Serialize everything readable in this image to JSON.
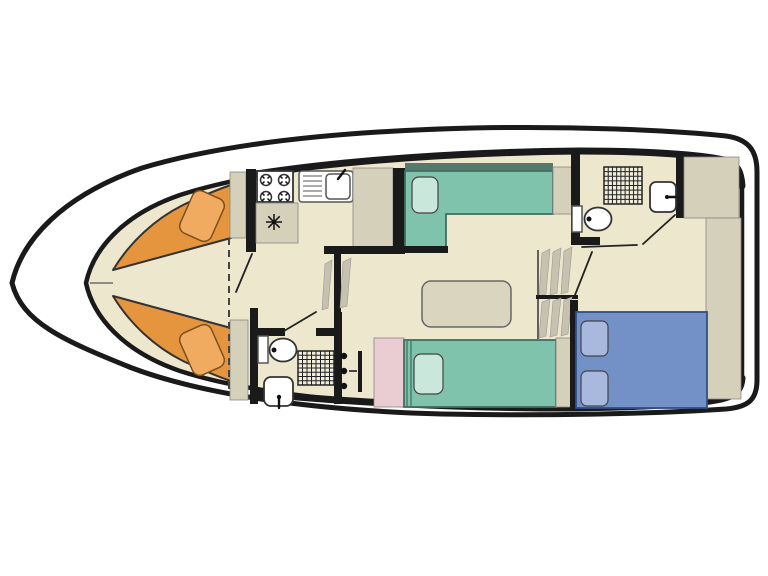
{
  "floorplan": {
    "type": "boat-floor-plan-top-view",
    "background": "#ffffff",
    "colors": {
      "outline": "#1a1a1a",
      "hull_white": "#ffffff",
      "floor": "#ECE7CD",
      "counter": "#D4D0B9",
      "berth_orange": "#E6953F",
      "pillow_orange": "#F0AB61",
      "bed_teal": "#7FC3AD",
      "pillow_teal": "#C9E7DA",
      "bed_teal_headrail": "#56796E",
      "bed_blue": "#7390C7",
      "pillow_blue": "#A9B9DE",
      "wardrobe_pink": "#EACCD3",
      "steps": "#C6C2AF",
      "table": "#D9D5BE",
      "appliance_panel": "#F2F0E6",
      "fixture_white": "#FFFFFF",
      "shower_floor": "#F0EDDA"
    },
    "rooms": {
      "bow_cabin": "v-berth-double",
      "galley": "kitchen-with-hob-sink-fridge",
      "saloon": "table-and-two-single-berths",
      "bathroom_mid": "toilet-shower-basin",
      "bathroom_aft": "toilet-shower-basin",
      "aft_cabin": "double-berth"
    },
    "fixtures": {
      "stove": "four-burner-hob",
      "sink": "sink-with-drainer-and-faucet",
      "fridge": "refrigerator-asterisk-symbol",
      "toilets": 2,
      "showers": 2,
      "washbasins": 2,
      "steps": "companionway-steps",
      "partition": "dashed-bow-partition"
    }
  }
}
